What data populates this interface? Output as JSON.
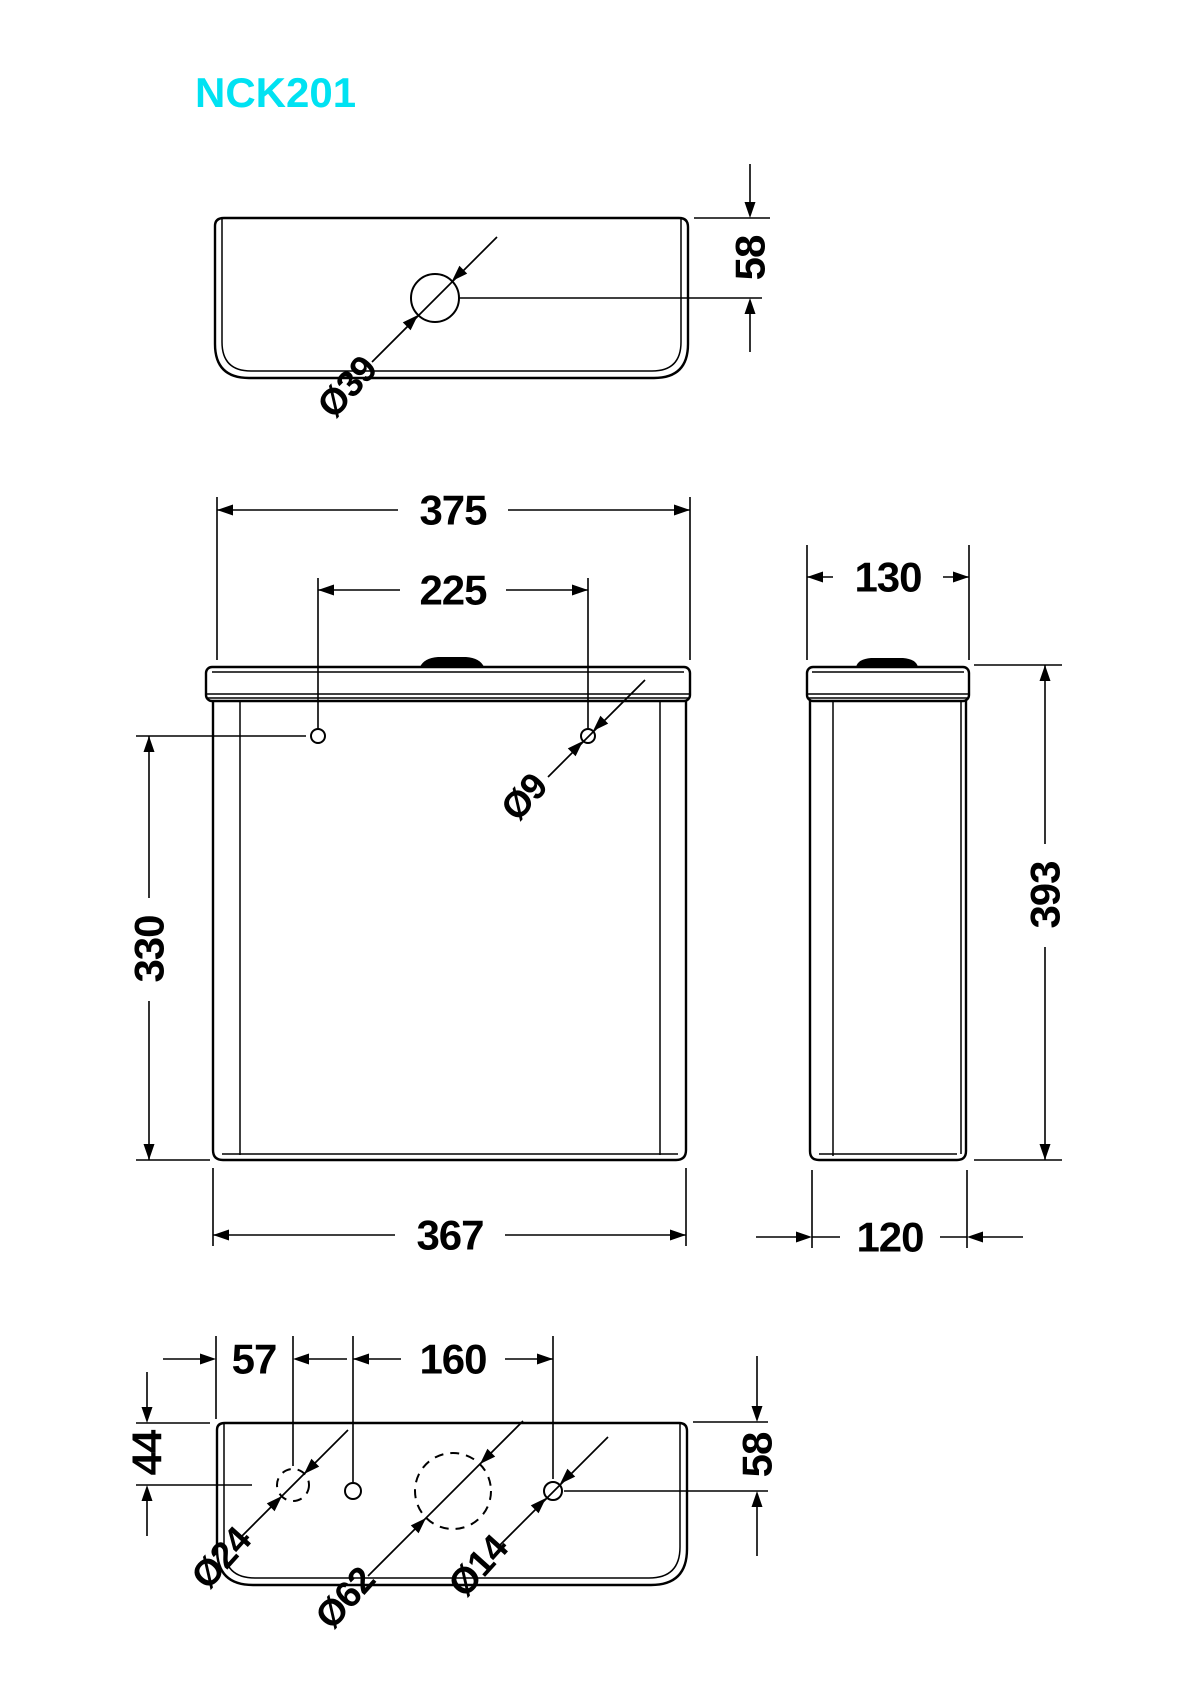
{
  "title": "NCK201",
  "accent_color": "#00e2f2",
  "views": {
    "top": {
      "button_hole_diameter": "Ø39",
      "hole_depth_offset": "58"
    },
    "front": {
      "lid_width": "375",
      "fixing_hole_spacing": "225",
      "hole_to_base_height": "330",
      "body_width": "367",
      "fixing_hole_diameter": "Ø9"
    },
    "side": {
      "lid_depth": "130",
      "overall_height": "393",
      "body_depth": "120"
    },
    "bottom": {
      "edge_to_inlet": "57",
      "hole_spacing": "160",
      "front_to_hole": "44",
      "front_to_hole_right": "58",
      "inlet_diameter": "Ø24",
      "outlet_diameter": "Ø62",
      "overflow_diameter": "Ø14"
    }
  }
}
